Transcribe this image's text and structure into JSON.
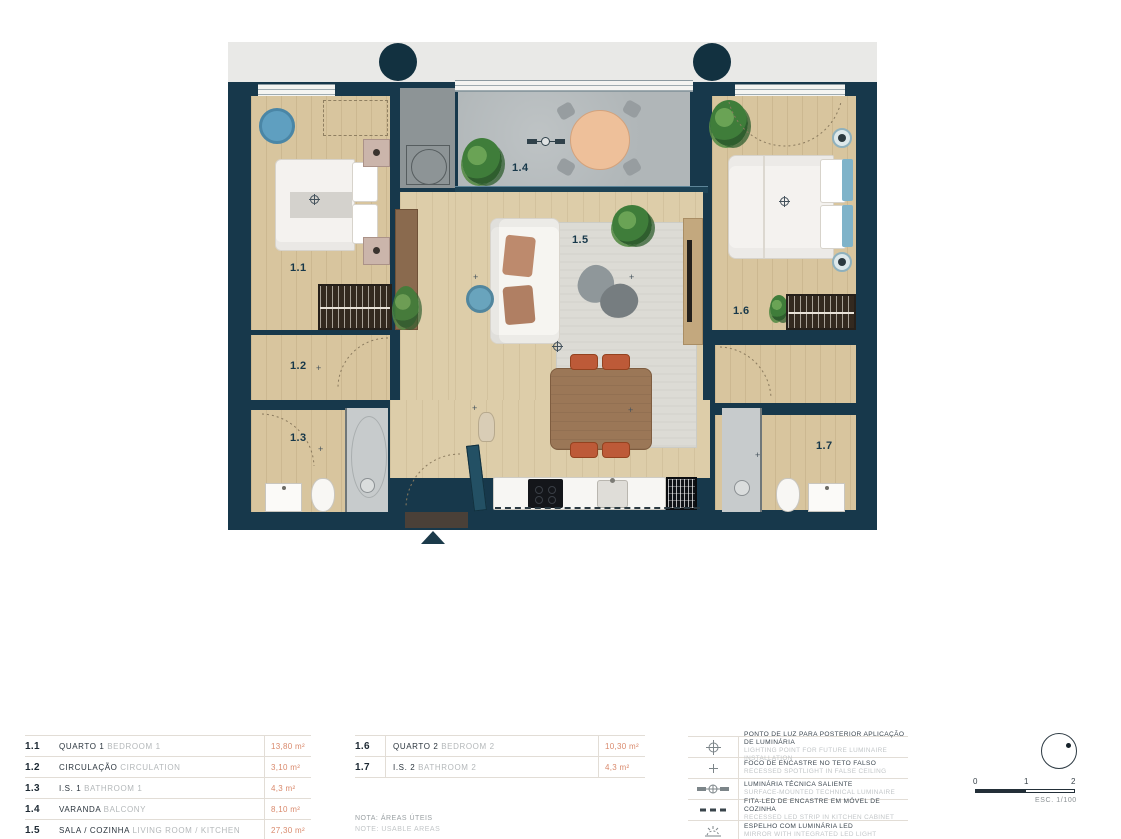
{
  "plan": {
    "room_labels": {
      "r11": "1.1",
      "r12": "1.2",
      "r13": "1.3",
      "r14": "1.4",
      "r15": "1.5",
      "r16": "1.6",
      "r17": "1.7"
    }
  },
  "tables": {
    "left": {
      "rows": [
        {
          "code": "1.1",
          "name_pt": "QUARTO 1",
          "name_en": "BEDROOM 1",
          "area": "13,80 m²"
        },
        {
          "code": "1.2",
          "name_pt": "CIRCULAÇÃO",
          "name_en": "CIRCULATION",
          "area": "3,10 m²"
        },
        {
          "code": "1.3",
          "name_pt": "I.S. 1",
          "name_en": "BATHROOM 1",
          "area": "4,3 m²"
        },
        {
          "code": "1.4",
          "name_pt": "VARANDA",
          "name_en": "BALCONY",
          "area": "8,10 m²"
        },
        {
          "code": "1.5",
          "name_pt": "SALA / COZINHA",
          "name_en": "LIVING ROOM / KITCHEN",
          "area": "27,30 m²"
        }
      ]
    },
    "right": {
      "rows": [
        {
          "code": "1.6",
          "name_pt": "QUARTO 2",
          "name_en": "BEDROOM 2",
          "area": "10,30 m²"
        },
        {
          "code": "1.7",
          "name_pt": "I.S. 2",
          "name_en": "BATHROOM 2",
          "area": "4,3 m²"
        }
      ]
    },
    "note_pt": "NOTA: ÁREAS ÚTEIS",
    "note_en": "NOTE: USABLE AREAS"
  },
  "lighting_legend": {
    "rows": [
      {
        "pt": "PONTO DE LUZ PARA POSTERIOR APLICAÇÃO DE LUMINÁRIA",
        "en": "LIGHTING POINT FOR FUTURE LUMINAIRE INSTALLATION"
      },
      {
        "pt": "FOCO DE ENCASTRE NO TETO FALSO",
        "en": "RECESSED SPOTLIGHT IN FALSE CEILING"
      },
      {
        "pt": "LUMINÁRIA TÉCNICA SALIENTE",
        "en": "SURFACE-MOUNTED TECHNICAL LUMINAIRE"
      },
      {
        "pt": "FITA-LED DE ENCASTRE EM MÓVEL DE COZINHA",
        "en": "RECESSED LED STRIP IN KITCHEN CABINET"
      },
      {
        "pt": "ESPELHO COM LUMINÁRIA LED",
        "en": "MIRROR WITH INTEGRATED LED LIGHT"
      }
    ]
  },
  "scale_bar": {
    "tick0": "0",
    "tick1": "1",
    "tick2": "2",
    "label": "ESC. 1/100"
  },
  "colors": {
    "wall": "#17384B",
    "wood": "#D8C59E",
    "balcony": "#B0B6B8",
    "accent": "#D9896C",
    "outside": "#E9E9E7"
  }
}
